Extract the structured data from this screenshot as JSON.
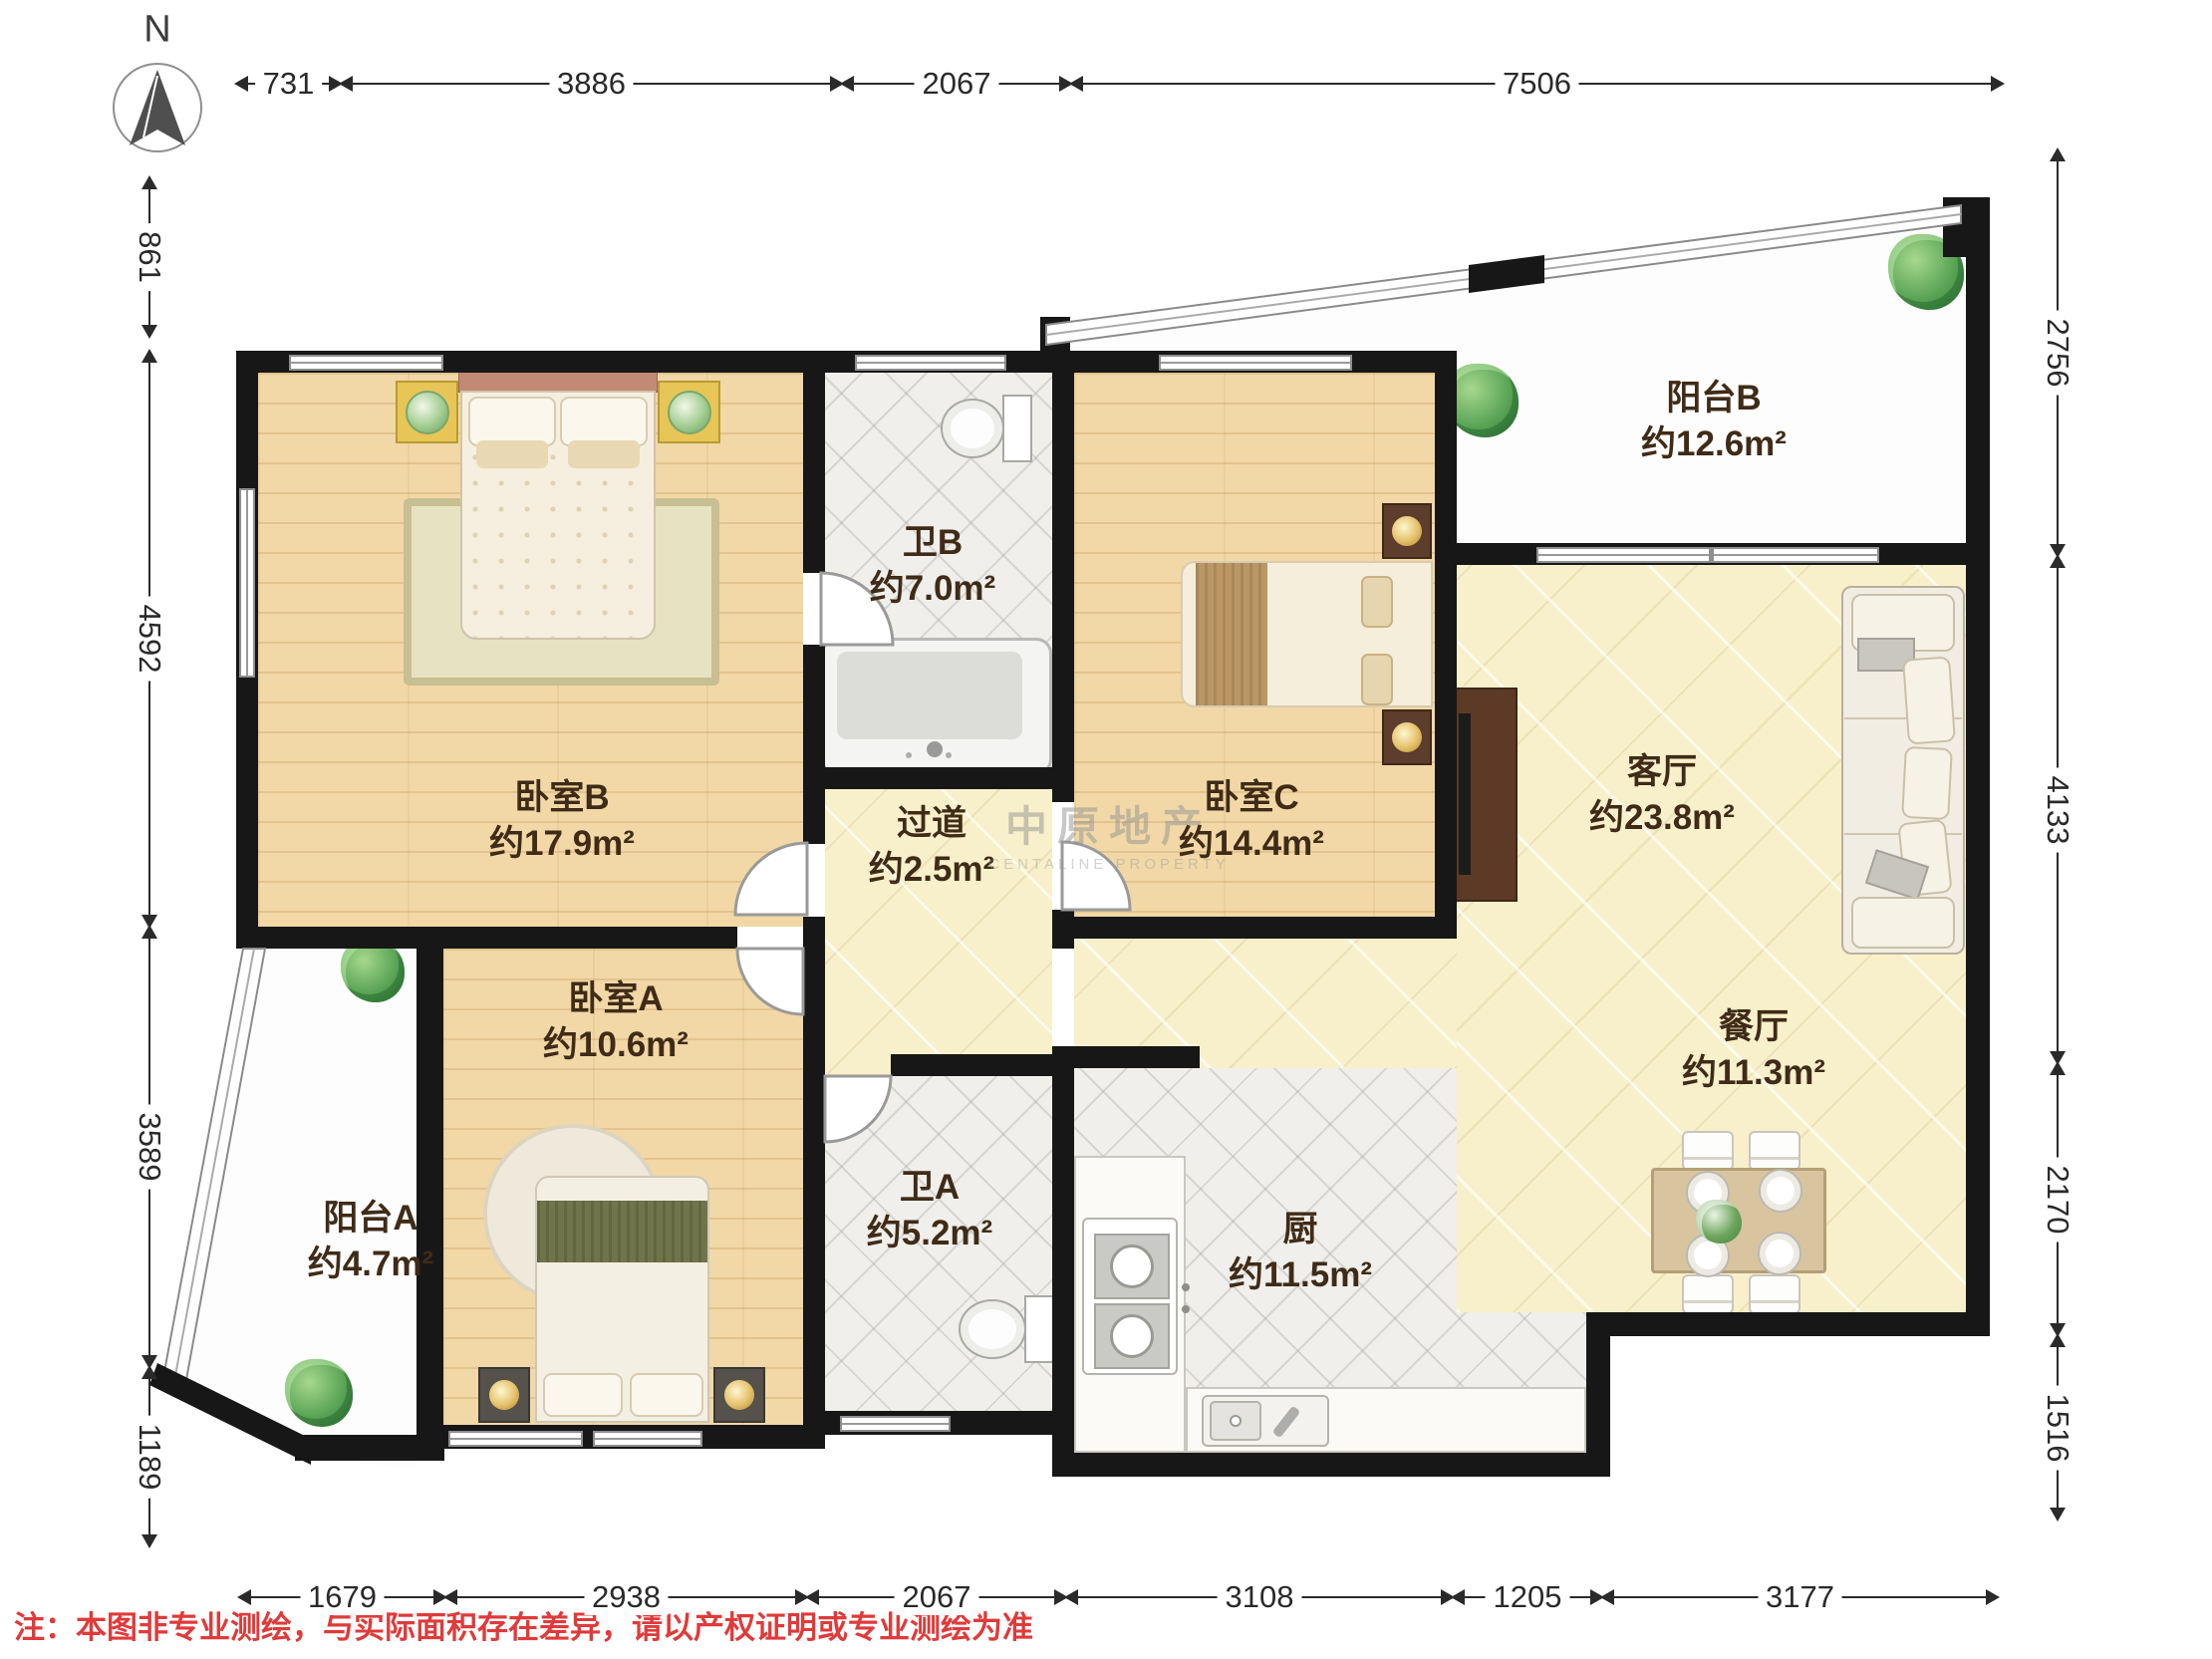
{
  "compass": {
    "label": "N"
  },
  "watermark": {
    "cn": "中原地产",
    "en": "CENTALINE PROPERTY"
  },
  "note": "注：本图非专业测绘，与实际面积存在差异，请以产权证明或专业测绘为准",
  "rooms": {
    "bedroom_b": {
      "name": "卧室B",
      "area": "约17.9m²"
    },
    "bath_b": {
      "name": "卫B",
      "area": "约7.0m²"
    },
    "hallway": {
      "name": "过道",
      "area": "约2.5m²"
    },
    "bedroom_c": {
      "name": "卧室C",
      "area": "约14.4m²"
    },
    "balcony_b": {
      "name": "阳台B",
      "area": "约12.6m²"
    },
    "living": {
      "name": "客厅",
      "area": "约23.8m²"
    },
    "dining": {
      "name": "餐厅",
      "area": "约11.3m²"
    },
    "bedroom_a": {
      "name": "卧室A",
      "area": "约10.6m²"
    },
    "balcony_a": {
      "name": "阳台A",
      "area": "约4.7m²"
    },
    "bath_a": {
      "name": "卫A",
      "area": "约5.2m²"
    },
    "kitchen": {
      "name": "厨",
      "area": "约11.5m²"
    }
  },
  "dimensions": {
    "top": {
      "axis": "h",
      "pos": 84,
      "segments": [
        {
          "label": "731",
          "from": 237,
          "to": 342
        },
        {
          "label": "3886",
          "from": 342,
          "to": 845
        },
        {
          "label": "2067",
          "from": 845,
          "to": 1075
        },
        {
          "label": "7506",
          "from": 1075,
          "to": 2010
        }
      ]
    },
    "bottom": {
      "axis": "h",
      "pos": 1603,
      "segments": [
        {
          "label": "1679",
          "from": 240,
          "to": 447
        },
        {
          "label": "2938",
          "from": 447,
          "to": 810
        },
        {
          "label": "2067",
          "from": 810,
          "to": 1070
        },
        {
          "label": "3108",
          "from": 1070,
          "to": 1458
        },
        {
          "label": "1205",
          "from": 1458,
          "to": 1608
        },
        {
          "label": "3177",
          "from": 1608,
          "to": 2005
        }
      ]
    },
    "left": {
      "axis": "v",
      "pos": 150,
      "segments": [
        {
          "label": "861",
          "from": 178,
          "to": 338
        },
        {
          "label": "4592",
          "from": 352,
          "to": 930
        },
        {
          "label": "3589",
          "from": 930,
          "to": 1372
        },
        {
          "label": "1189",
          "from": 1372,
          "to": 1552
        }
      ]
    },
    "right": {
      "axis": "v",
      "pos": 2065,
      "segments": [
        {
          "label": "2756",
          "from": 150,
          "to": 558
        },
        {
          "label": "4133",
          "from": 558,
          "to": 1067
        },
        {
          "label": "2170",
          "from": 1067,
          "to": 1340
        },
        {
          "label": "1516",
          "from": 1340,
          "to": 1525
        }
      ]
    }
  },
  "colors": {
    "wall": "#171717",
    "label_text": "#3f2b17",
    "note_red": "#e03a3a",
    "wood_floor": "#f1d8a6",
    "marble_floor": "#f8f0ca",
    "tile_floor": "#f0efeb"
  }
}
